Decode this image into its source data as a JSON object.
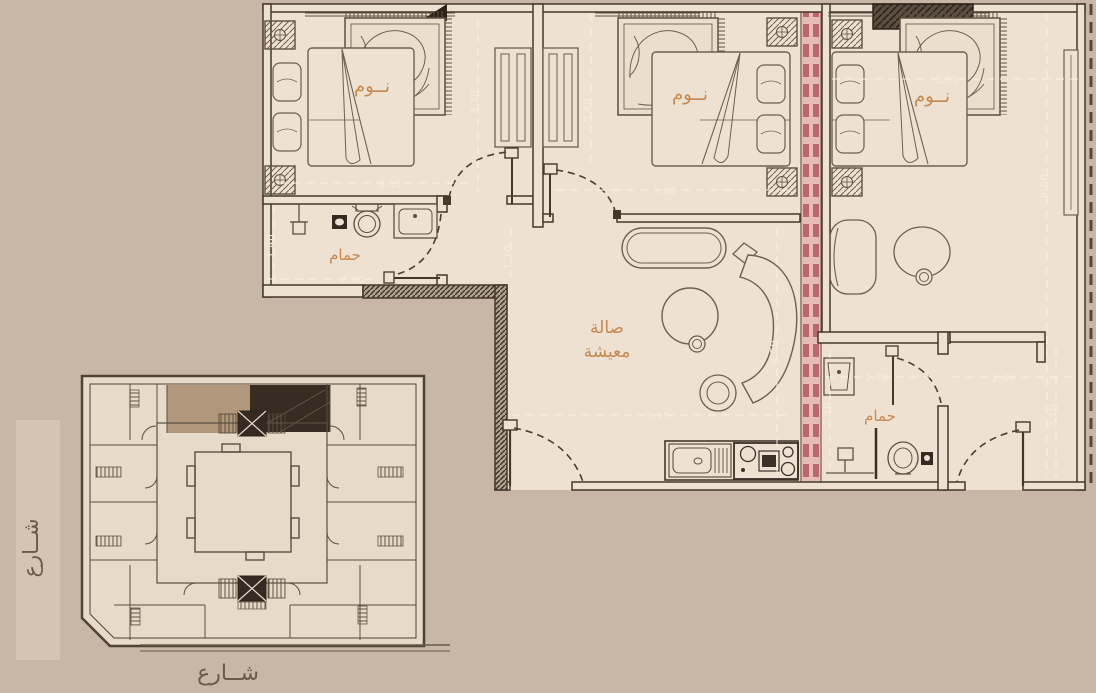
{
  "plan": {
    "rooms": {
      "bedroom1": {
        "label": "نــوم",
        "dim_w": "3.65",
        "dim_h": "3.30"
      },
      "bedroom2": {
        "label": "نــوم",
        "dim_w": "3.65",
        "dim_h": "3.60"
      },
      "bedroom3": {
        "label": "نــوم",
        "dim_w": "3.65",
        "dim_h": "6.00"
      },
      "bath1": {
        "label": "حمام",
        "dim_w": "2.40",
        "dim_h": "1.40"
      },
      "bath2": {
        "label": "حمام",
        "dim_w": "1.70",
        "dim_h": "2.10"
      },
      "hall": {
        "dim_w": "1.80",
        "dim_h": "2.10"
      },
      "living": {
        "label_line1": "صالة",
        "label_line2": "معيشة",
        "dim_w": "3.95",
        "dim_h": "4.50"
      },
      "corridor": {
        "dim_h": "1.10"
      }
    }
  },
  "streets": {
    "left": "شــارع",
    "bottom": "شــارع"
  },
  "colors": {
    "background": "#c8b6a6",
    "floor": "#eee1d2",
    "wall": "#44382c",
    "furniture": "#6e5f4f",
    "room_label": "#c6884e",
    "dimension_text": "#f5ecda",
    "expansion_joint": "#dca3a2",
    "expansion_joint_dash": "#bb676d",
    "highlight_unit_tan": "#b1977b",
    "highlight_unit_dark": "#362c22"
  }
}
